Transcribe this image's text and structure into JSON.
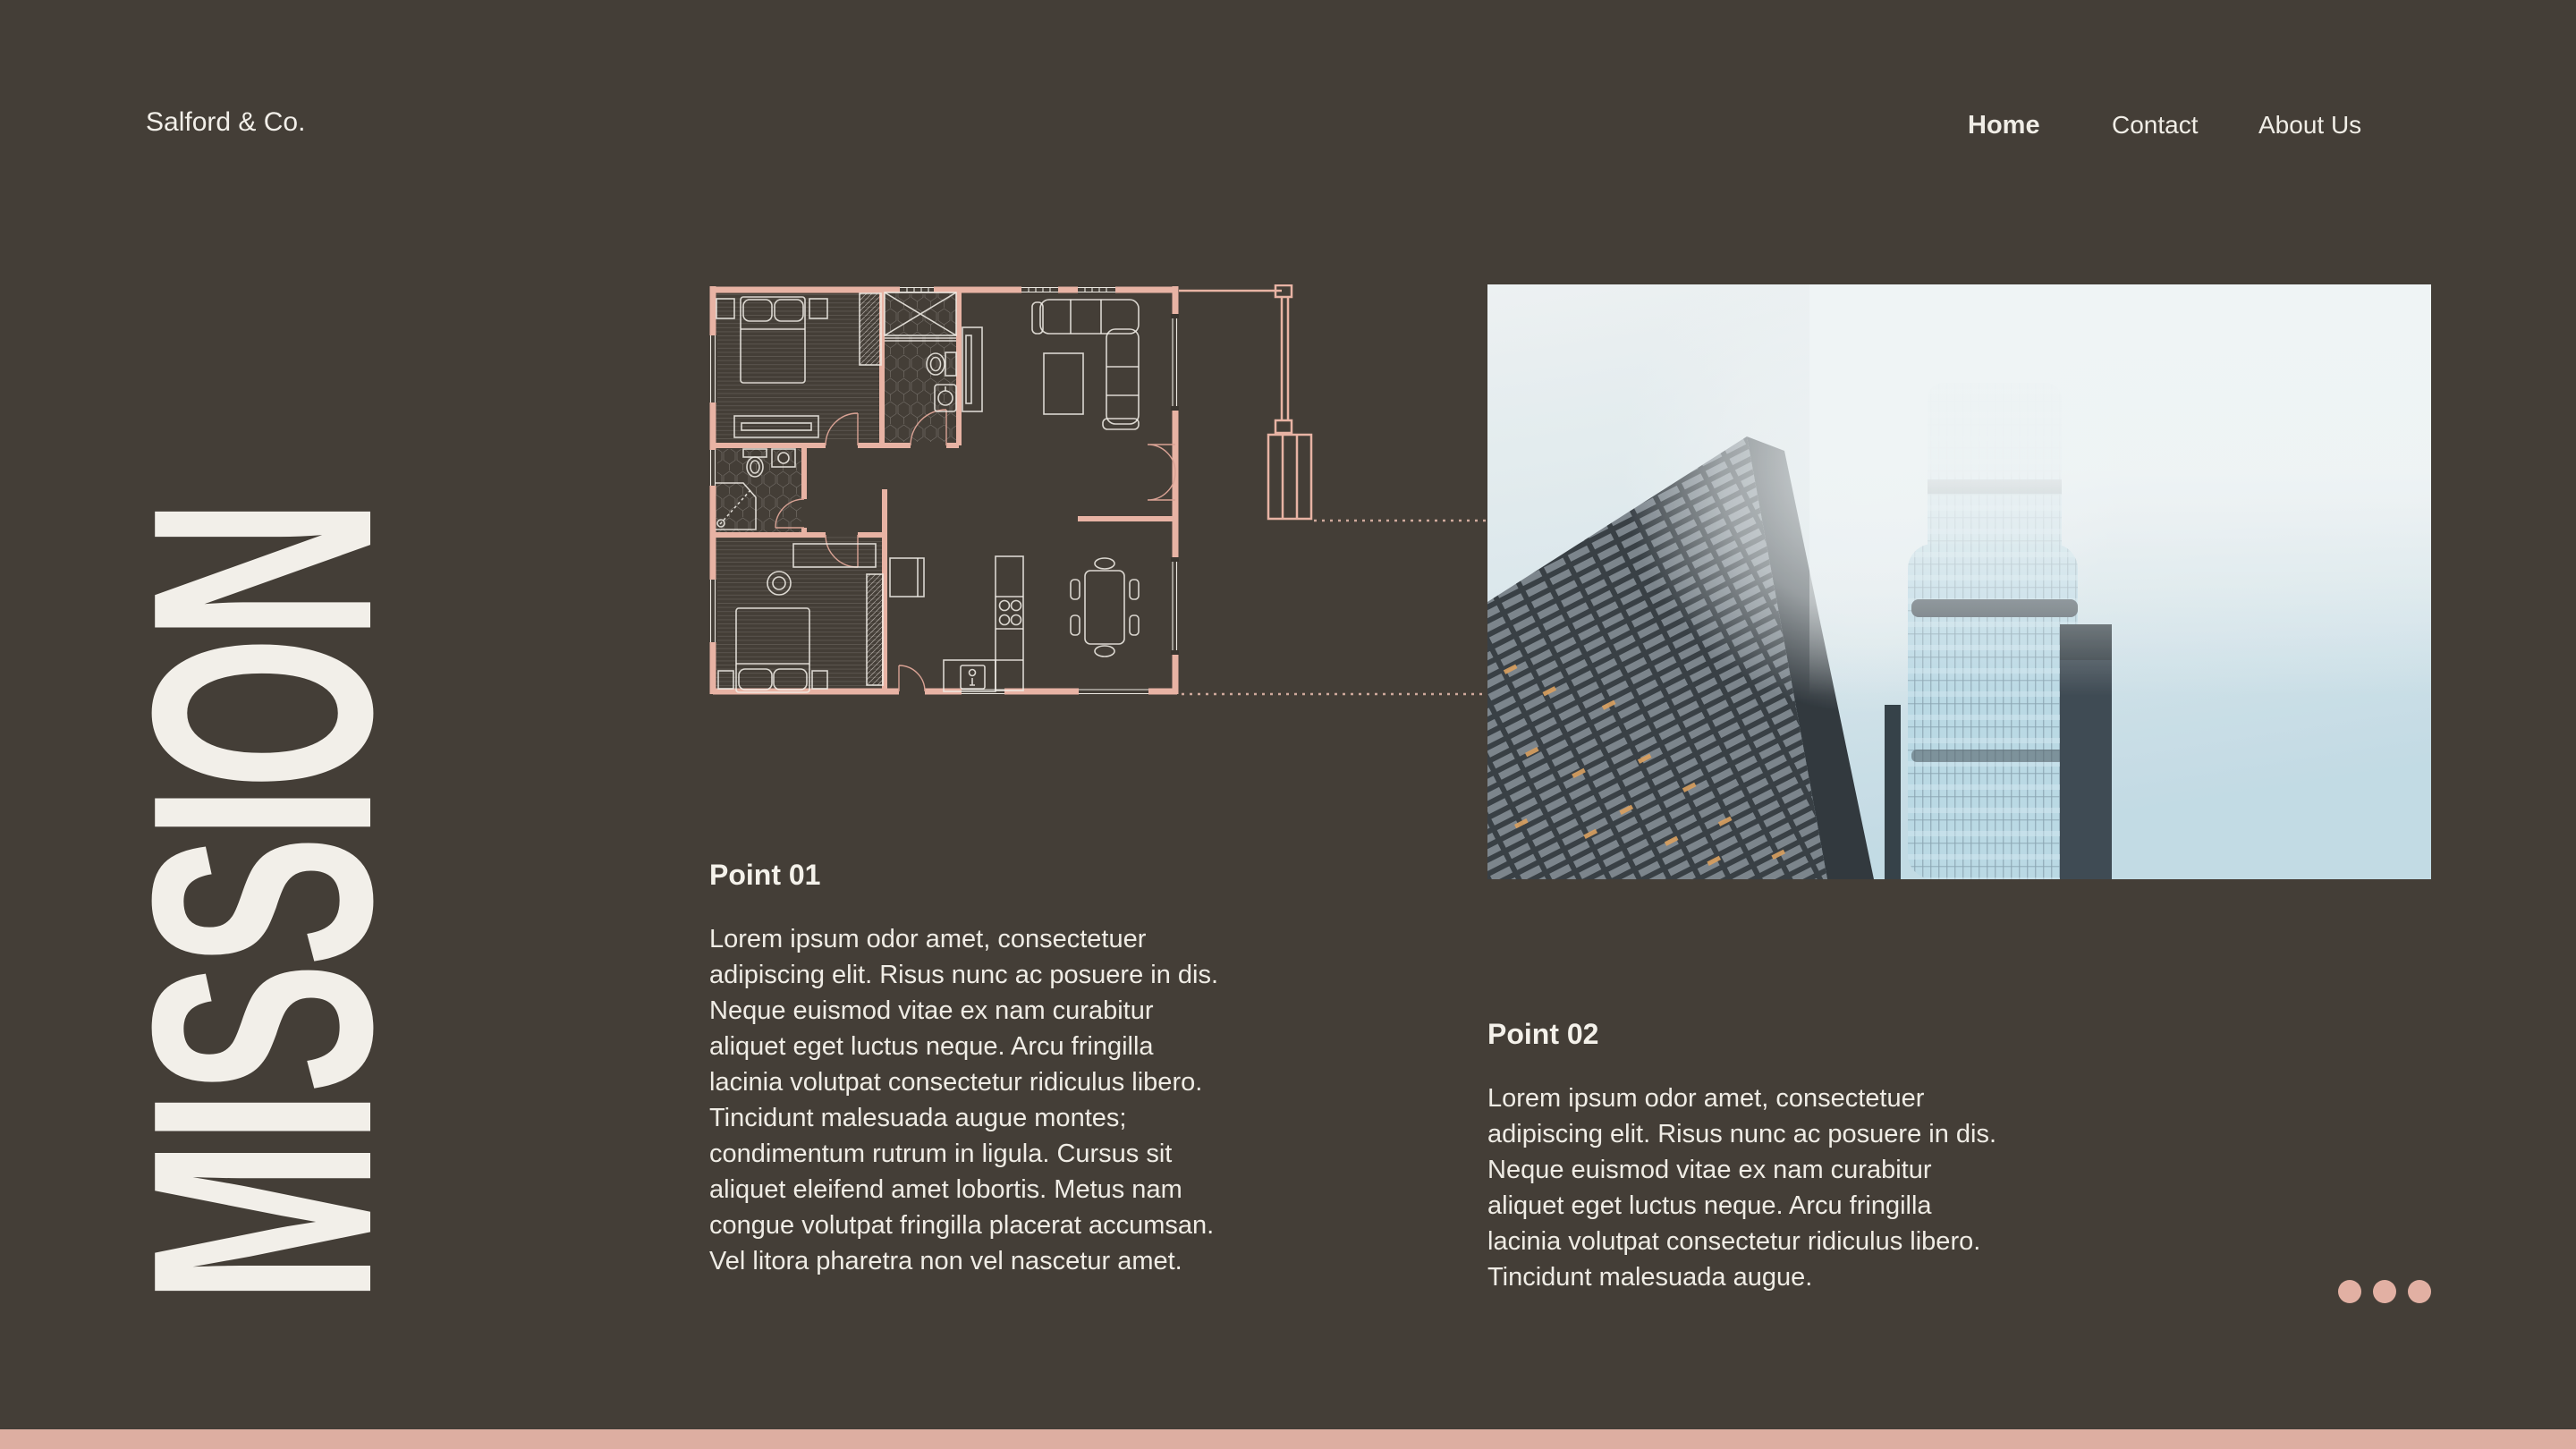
{
  "page": {
    "background_color": "#443e37",
    "accent_pink": "#e8b3a4",
    "accent_pink_soft": "#ddaea1",
    "cream": "#f2efe9"
  },
  "header": {
    "brand": "Salford & Co.",
    "nav": [
      {
        "label": "Home",
        "active": true
      },
      {
        "label": "Contact",
        "active": false
      },
      {
        "label": "About Us",
        "active": false
      }
    ]
  },
  "hero": {
    "vertical_title": "MISSION"
  },
  "sections": [
    {
      "heading": "Point 01",
      "body": "Lorem ipsum odor amet, consectetuer\nadipiscing elit. Risus nunc ac posuere in dis.\nNeque euismod vitae ex nam curabitur\naliquet eget luctus neque. Arcu fringilla\nlacinia volutpat consectetur ridiculus libero.\nTincidunt malesuada augue montes;\ncondimentum rutrum in ligula. Cursus sit\naliquet eleifend amet lobortis. Metus nam\ncongue volutpat fringilla placerat accumsan.\nVel litora pharetra non vel nascetur amet."
    },
    {
      "heading": "Point 02",
      "body": "Lorem ipsum odor amet, consectetuer\nadipiscing elit. Risus nunc ac posuere in dis.\nNeque euismod vitae ex nam curabitur\naliquet eget luctus neque. Arcu fringilla\nlacinia volutpat consectetur ridiculus libero.\nTincidunt malesuada augue."
    }
  ],
  "carousel": {
    "dot_count": 3
  }
}
